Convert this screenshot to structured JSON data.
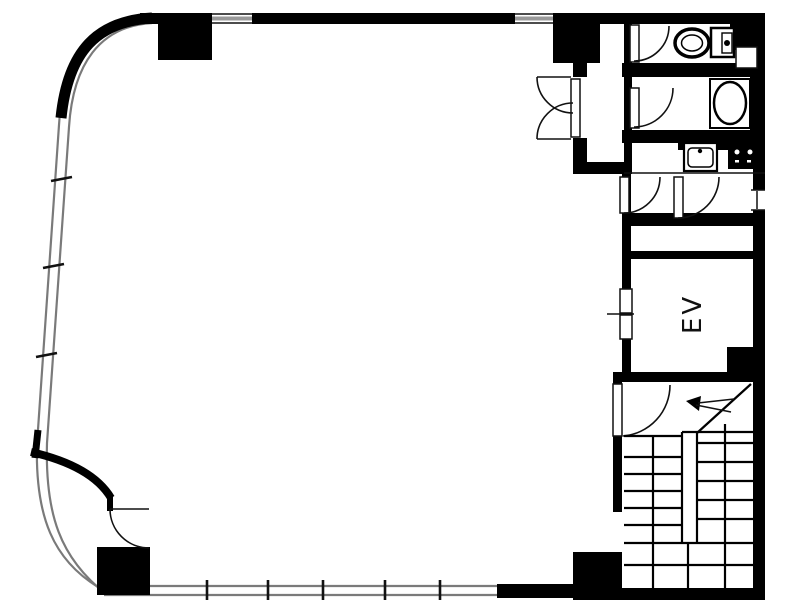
{
  "title": "building-floor-plan",
  "labels": {
    "elevator": "EV"
  },
  "colors": {
    "wall": "#000000",
    "ink": "#111111",
    "background": "#ffffff",
    "window_line": "#7a7a7a"
  },
  "icons": {
    "toilet": "toilet-icon",
    "bathtub": "bathtub-icon",
    "kitchen_sink": "sink-icon",
    "stove": "stove-icon",
    "stair_up_arrow": "up-arrow-icon",
    "door_swings": "door-arc-icon",
    "window_mullions": "window-tick-icon"
  }
}
